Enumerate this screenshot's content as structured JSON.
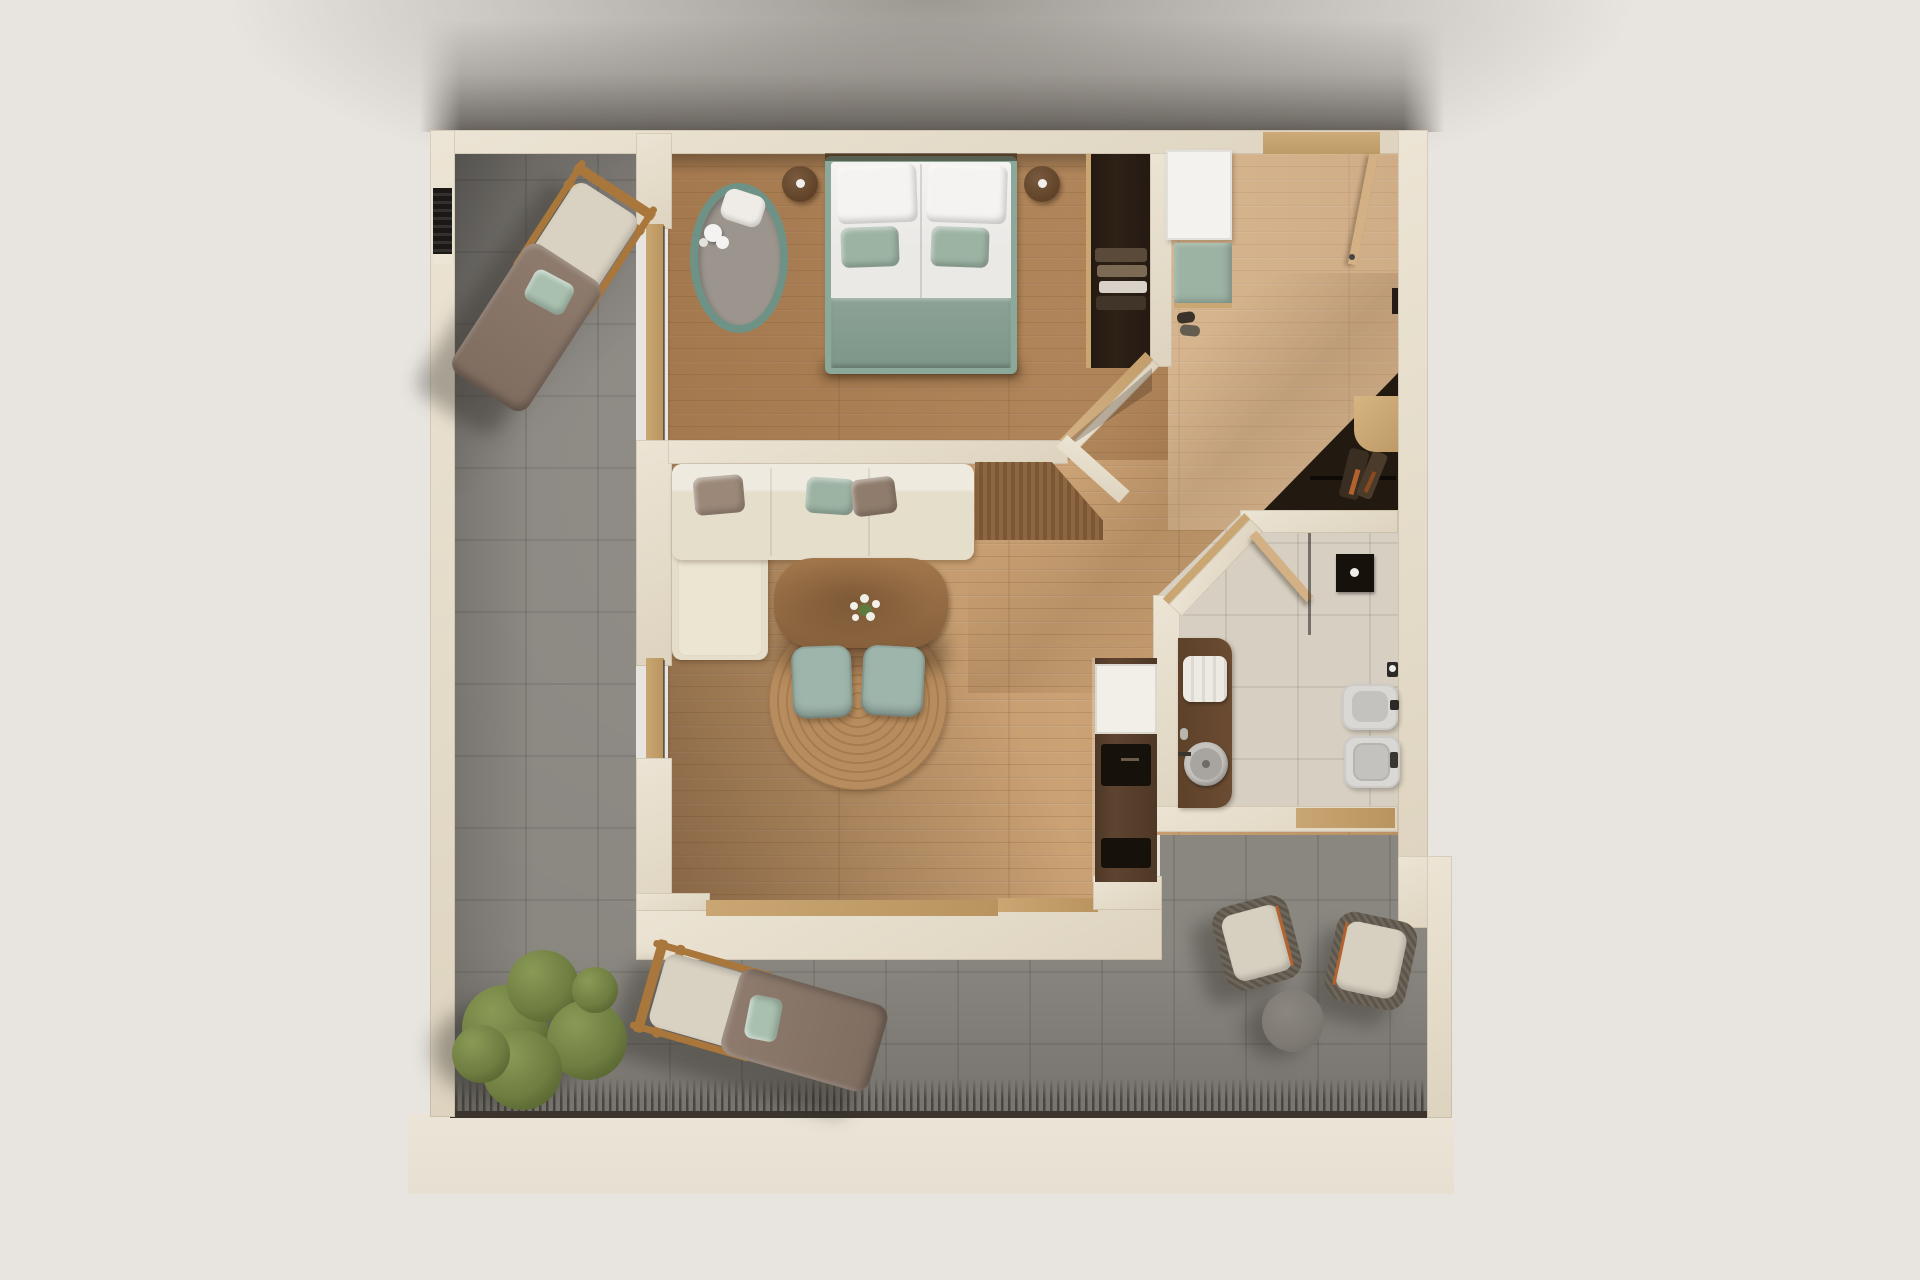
{
  "meta": {
    "title": "apartment-floor-plan-3d-top-view",
    "type": "architectural render, orthographic top view, no text labels"
  },
  "rooms": [
    {
      "name": "bedroom",
      "floor": "dark oak wood",
      "position": "top-left"
    },
    {
      "name": "hallway-entry",
      "floor": "light oak wood",
      "position": "top-right"
    },
    {
      "name": "living-dining",
      "floor": "oak wood",
      "position": "center"
    },
    {
      "name": "kitchenette",
      "floor": "oak wood",
      "position": "center-right column"
    },
    {
      "name": "bathroom",
      "floor": "beige stone tile",
      "position": "right"
    },
    {
      "name": "storage-niche",
      "floor": "dark",
      "position": "right of corridor"
    },
    {
      "name": "terrace",
      "floor": "grey stone tile",
      "position": "left and bottom L-shape"
    }
  ],
  "furniture": {
    "bedroom": [
      "double-bed with white duvets, white pillows, sage pillows, sage runner",
      "round nightstand left",
      "round nightstand right",
      "oval rug green border with plush toy",
      "dark open wardrobe with clothes",
      "open door to corridor"
    ],
    "hallway": [
      "entry door with open leaf",
      "white shoe cabinet",
      "sage bench cushion",
      "shoes",
      "storage niche with rail and gear",
      "small wood desk shelf"
    ],
    "living": [
      "L-shaped cream sofa with brown and sage cushions",
      "wood dining table with white flowers",
      "two sage dining chairs",
      "round jute rug",
      "wood partition panel"
    ],
    "kitchenette": [
      "white counter block",
      "dark sink inset with faucet",
      "dark appliance inset"
    ],
    "bathroom": [
      "brown vanity with towels and round grey vessel sink",
      "walk-in shower with black head and glass panel",
      "white bidet",
      "white toilet",
      "toilet paper holder",
      "wood door leaf"
    ],
    "terrace": [
      "sun lounger top-left rotated",
      "sun lounger bottom rotated",
      "green shrub tree",
      "two woven armchairs bottom-right",
      "round grey side table",
      "decking fringe shadow edge",
      "dark wall vent niche"
    ]
  },
  "palette": {
    "bg": "#e8e4df",
    "wall": "#ece4d4",
    "wall-deep": "#ddd3bf",
    "base": "#ebe4d7",
    "terrace": "#8a8680",
    "fringe": "#3b352e",
    "wood": "#c49a6c",
    "bath-floor": "#d7d0c2",
    "niche-dark": "#221910",
    "wardrobe-dark": "#2e2116",
    "sill-wood": "#c9a672",
    "door-wood": "#d3b184",
    "unit-white": "#f4f2ee",
    "soft-green": "#9cb3a3",
    "rug-border-green": "#6e9386",
    "rug-gray": "#9b958d",
    "duvet-white": "#ebe9e6",
    "pillow-white": "#f4f3f1",
    "runner-green": "#8ba295",
    "bed-frame-green": "#8aa99b",
    "sofa-cream": "#e5decb",
    "sofa-cream-light": "#ece5d2",
    "cushion-brown": "#9b8878",
    "cushion-brown-deep": "#8f7c6c",
    "table-wood": "#a1764b",
    "table-wood-deep": "#86603c",
    "jute": "#b78c5e",
    "jute-deep": "#a67c4e",
    "chair-green": "#9eb5ab",
    "cabinet-brown": "#5e4430",
    "appliance-black": "#17110c",
    "counter-white": "#f2efe9",
    "vanity-brown": "#6b4c33",
    "towel-white": "#edeae4",
    "ceramic-white": "#d9d8d5",
    "ceramic-gray": "#c3c2bf",
    "lounger-wood": "#a9763c",
    "lounger-taupe": "#8e7b6d",
    "lounger-cream": "#d9d2c3",
    "outdoor-pillow-green": "#a9c0af",
    "tree-light": "#8a9a55",
    "tree-mid": "#6f7e41",
    "tree-dark": "#4c5929",
    "outdoor-chair-frame": "#6e665a",
    "outdoor-cushion": "#d7d0c1",
    "accent-orange": "#b4622d",
    "outdoor-table-gray": "#7e7a73",
    "glass-line": "rgba(35,35,35,0.55)"
  }
}
